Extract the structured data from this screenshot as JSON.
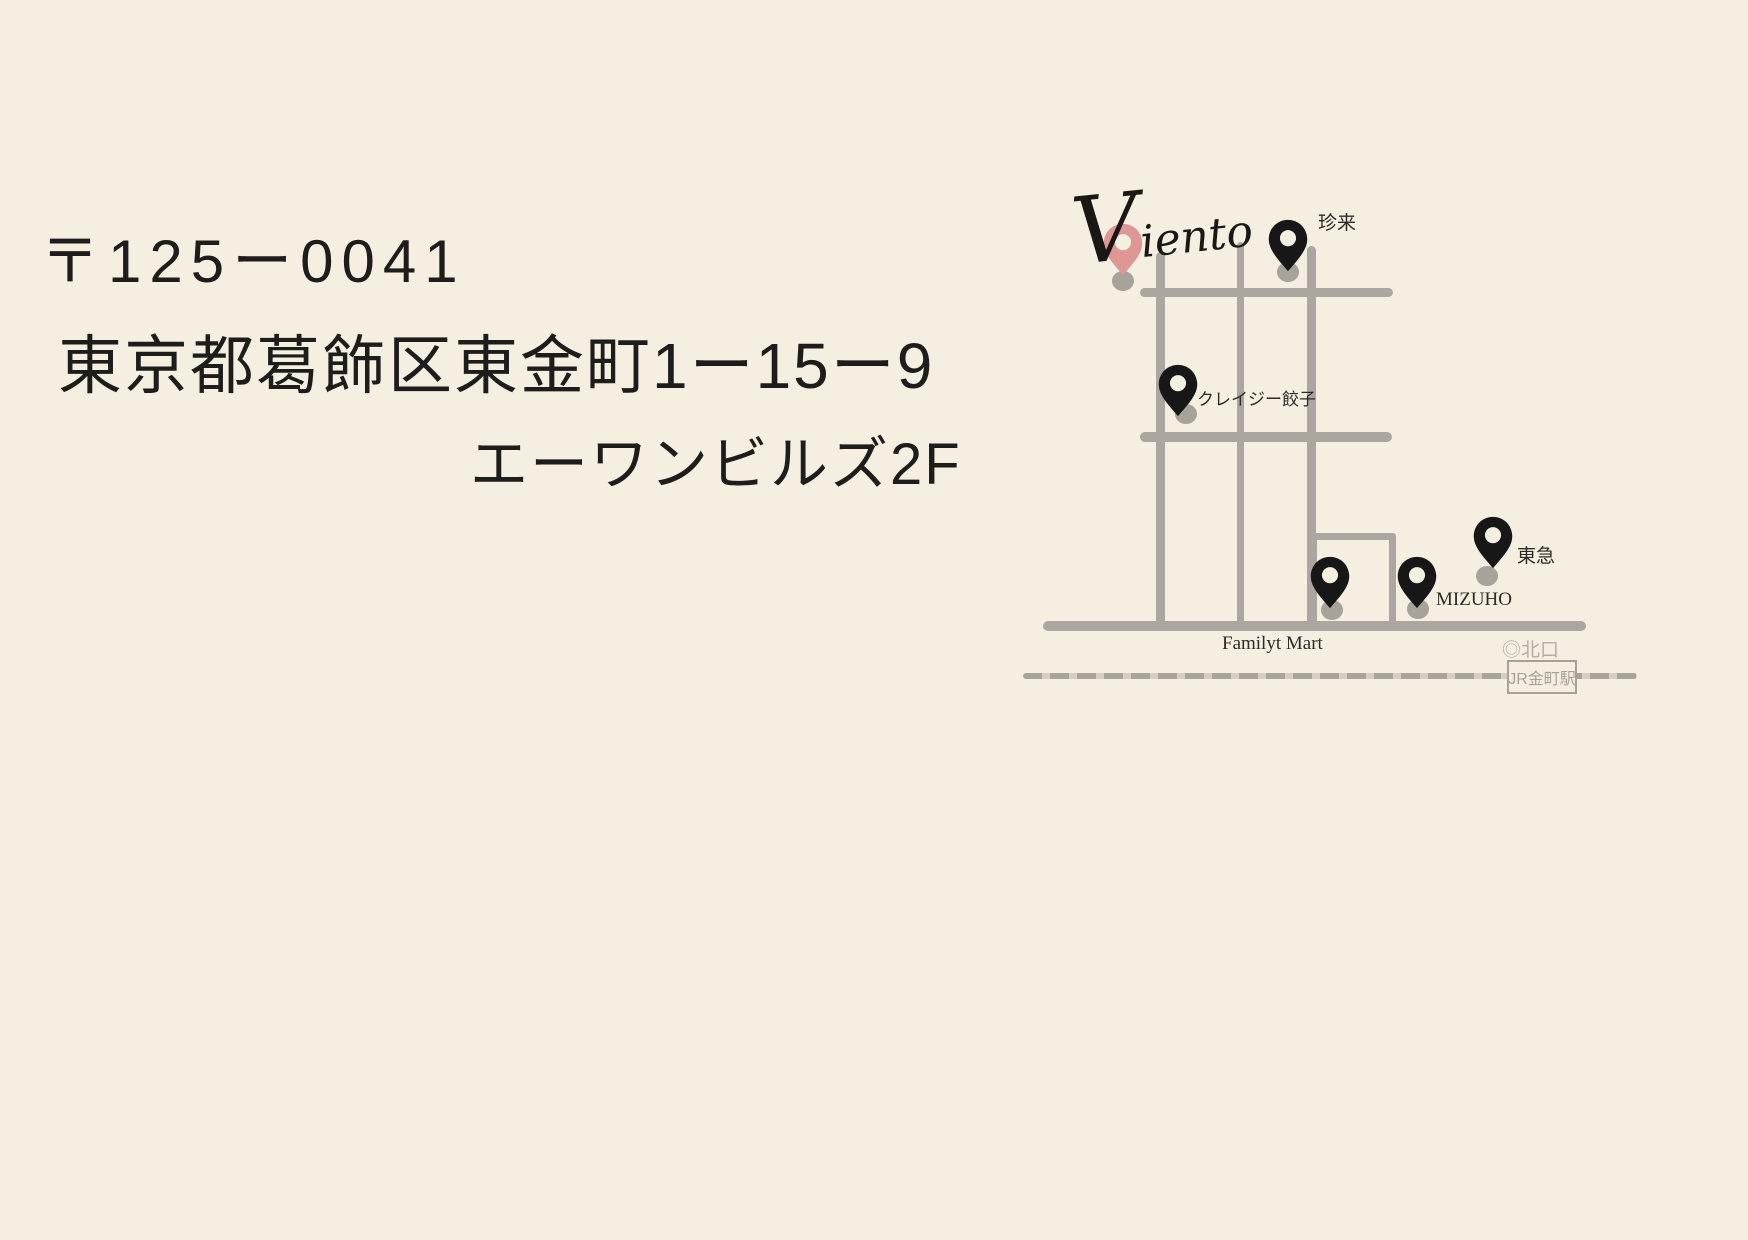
{
  "page": {
    "background_color": "#f5efe1"
  },
  "address": {
    "postal_code": "〒125ー0041",
    "line1": "東京都葛飾区東金町1ー15ー9",
    "line2": "エーワンビルズ2F"
  },
  "map": {
    "logo_text": "Viento",
    "labels": {
      "chinrai": "珍来",
      "crazy_gyoza": "クレイジー餃子",
      "tokyu": "東急",
      "mizuho": "MIZUHO",
      "family_mart": "Familyt Mart",
      "north_exit": "◎北口",
      "station": "JR金町駅"
    },
    "colors": {
      "road_gray": "#aba7a0",
      "railway_dash": "#a8a49c",
      "railway_gap": "#d4cfc2",
      "pin_black": "#171717",
      "pin_accent_pink": "#de9795",
      "shadow_dot_gray": "#a7a39b",
      "station_gray": "#a6a29a",
      "label_dark": "#2b2a27",
      "address_text": "#1e1d1b"
    }
  }
}
